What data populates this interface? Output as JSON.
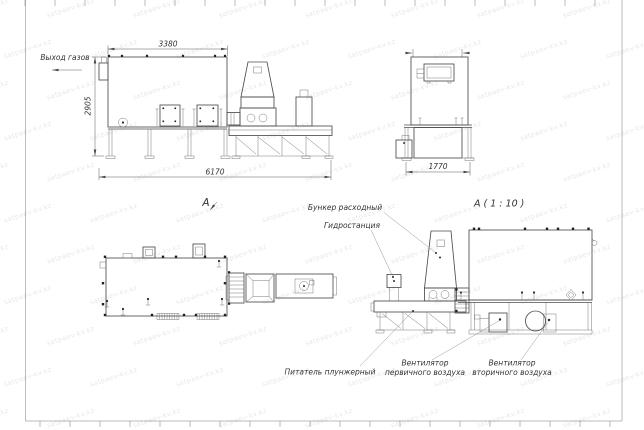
{
  "sheet": {
    "watermark_text": "satpaev-kv.kz"
  },
  "side_view": {
    "gas_outlet_label": "Выход газов",
    "view_label": "А",
    "dim_top_width": "3380",
    "dim_height": "2905",
    "dim_total_length": "6170"
  },
  "front_view": {
    "dim_width": "1770",
    "scale_label": "А ( 1 : 10 )"
  },
  "annotations": {
    "hopper": "Бункер расходный",
    "hydro_station": "Гидростанция",
    "plunger_feeder": "Питатель плунжерный",
    "primary_fan_line1": "Вентилятор",
    "primary_fan_line2": "первичного воздуха",
    "secondary_fan_line1": "Вентилятор",
    "secondary_fan_line2": "вторичного воздуха"
  }
}
